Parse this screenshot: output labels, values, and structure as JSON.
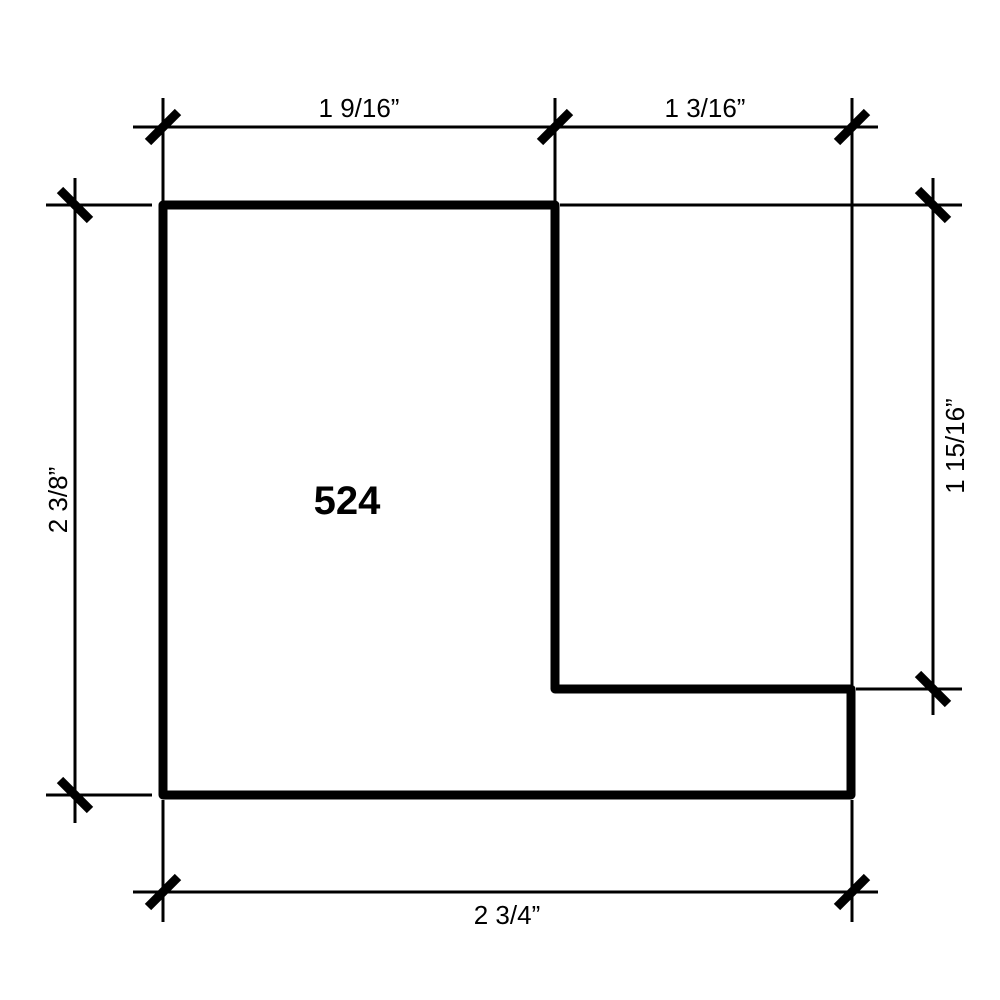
{
  "drawing": {
    "profile_number": "524",
    "dimensions": {
      "top_left": "1 9/16”",
      "top_right": "1 3/16”",
      "left": "2 3/8”",
      "right": "1 15/16”",
      "bottom": "2 3/4”"
    },
    "colors": {
      "line": "#000000",
      "background": "#ffffff"
    }
  }
}
